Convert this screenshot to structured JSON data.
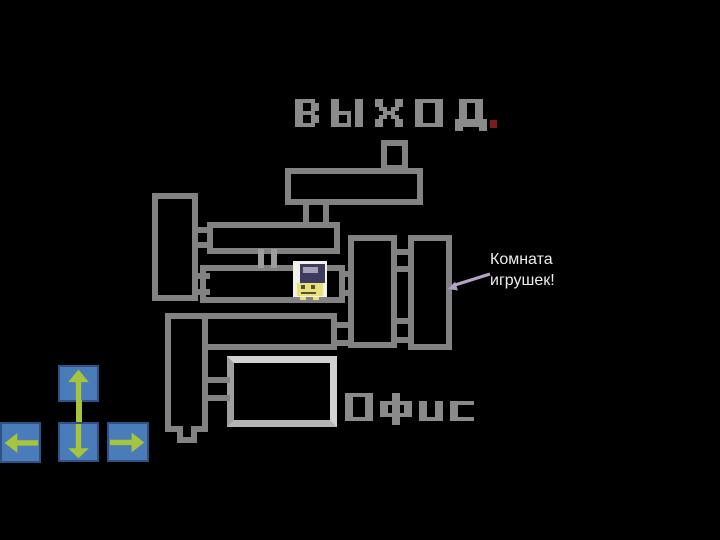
{
  "slide": {
    "background": "#000000"
  },
  "labels": {
    "exit": "ВЫХОД",
    "office": "Офис",
    "pixel_color": "#8a8a8a"
  },
  "red_pixel": {
    "color": "#7c1b1b"
  },
  "annotation": {
    "line1": "Комната",
    "line2": "игрушек!",
    "text_color": "#ececec",
    "arrow_color": "#b2a2c7",
    "arrow_icon": "left-down-arrow-icon"
  },
  "map": {
    "wall_color": "#828282",
    "office_wall_color": "#d2d2d2",
    "room_fill": "#000000"
  },
  "character": {
    "name": "player-character",
    "body_color": "#f2f2e9",
    "cap_color": "#3d3b60",
    "visor_color": "#a5a2b8",
    "face_color": "#e7e07b",
    "detail_color": "#55503a"
  },
  "controls": {
    "fill": "#4a7cba",
    "border": "#2d5384",
    "arrow_color": "#a6c43c",
    "buttons": [
      {
        "id": "up",
        "icon": "arrow-up-icon"
      },
      {
        "id": "left",
        "icon": "arrow-left-icon"
      },
      {
        "id": "down",
        "icon": "arrow-down-icon"
      },
      {
        "id": "right",
        "icon": "arrow-right-icon"
      }
    ]
  }
}
